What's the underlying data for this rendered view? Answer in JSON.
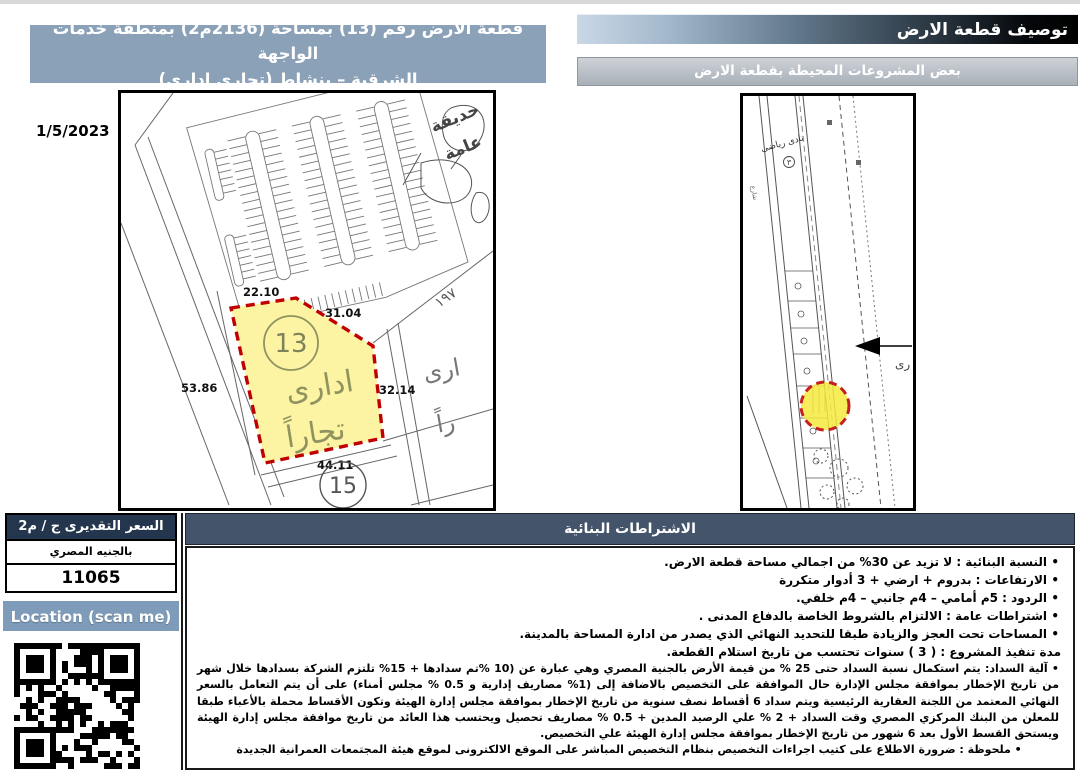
{
  "header": {
    "title": "توصيف قطعة الارض",
    "subtitle": "بعض المشروعات المحيطة بقطعة الارض"
  },
  "plot_banner": {
    "line1": "قطعة الارض رقم (13) بمساحة (2136م2) بمنطقة خدمات الواجهة",
    "line2": "الشرقية – بنشاط (تجارى ادارى)"
  },
  "date": "1/5/2023",
  "plot_map": {
    "plot_number": "13",
    "use_word1": "ادارى",
    "use_word2": "تجاراً",
    "neighbor_plot_number": "15",
    "garden_word1": "حديقة",
    "garden_word2": "عامة",
    "partial_label1": "ارى",
    "partial_label2": "راً",
    "corner_number": "١٩٧",
    "dim_top": "22.10",
    "dim_upper_right": "31.04",
    "dim_left": "53.86",
    "dim_right": "32.14",
    "dim_bottom": "44.11"
  },
  "site_map": {
    "club_label": "نادى رياضى",
    "club_number": "٣",
    "arrow_label": "رى",
    "street_label": "شارع"
  },
  "price_table": {
    "header": "السعر التقديرى ج / م2",
    "currency_label": "بالجنيه المصري",
    "price_value": "11065"
  },
  "location_button_label": "Location (scan me)",
  "requirements": {
    "header": "الاشتراطات البنائية",
    "bullets": [
      "النسبة البنائية : لا تزيد عن 30% من اجمالي مساحة قطعة الارض.",
      "الارتفاعات : بدروم + ارضي + 3 أدوار متكررة",
      "الردود : 5م أمامي – 4م جانبي – 4م خلفي.",
      "اشتراطات عامة : الالتزام بالشروط الخاصة بالدفاع المدنى .",
      "المساحات تحت العجز والزيادة طبقا للتحديد النهائي الذي يصدر من ادارة المساحة بالمدينة."
    ],
    "duration_line": "مدة تنفيذ المشروع : ( 3 ) سنوات تحتسب من تاريخ استلام القطعة.",
    "payment_line": "آلية السداد: يتم استكمال نسبة السداد حتى 25 % من قيمة الأرض بالجنية المصري وهي عبارة عن (10 %تم سدادها + 15% تلتزم الشركة بسدادها خلال شهر من تاريخ الإخطار بموافقة مجلس الإدارة حال الموافقة على التخصيص بالاضافة إلى (1% مصاريف إدارية و 0.5 % مجلس أمناء) على أن يتم التعامل بالسعر النهائي المعتمد من اللجنة العقارية الرئيسية ويتم سداد 6 أقساط نصف سنوية من تاريخ الإخطار بموافقة مجلس إدارة الهيئة وتكون الأقساط محملة بالأعباء طبقا للمعلن من البنك المركزي المصري وقت السداد + 2 % علي الرصيد المدين + 0.5 % مصاريف تحصيل ويحتسب هذا العائد من تاريخ موافقة مجلس إدارة الهيئة ويستحق القسط الأول بعد 6 شهور من تاريخ الإخطار بموافقة مجلس إدارة الهيئة علي التخصيص.",
    "note_line": "ملحوظة : ضرورة الاطلاع على كتيب اجراءات التخصيص بنظام التخصيص المباشر على الموقع الالكترونى لموقع هيئة المجتمعات العمرانية الجديدة"
  },
  "colors": {
    "banner_blue": "#8ba1b7",
    "button_blue": "#7e9cb9",
    "slate_header": "#44546a",
    "navy_header": "#24364e",
    "plot_yellow": "#fcf3a3",
    "highlight_yellow": "#f6e93c",
    "dashed_red": "#c00000",
    "olive_label": "#8f935f"
  }
}
